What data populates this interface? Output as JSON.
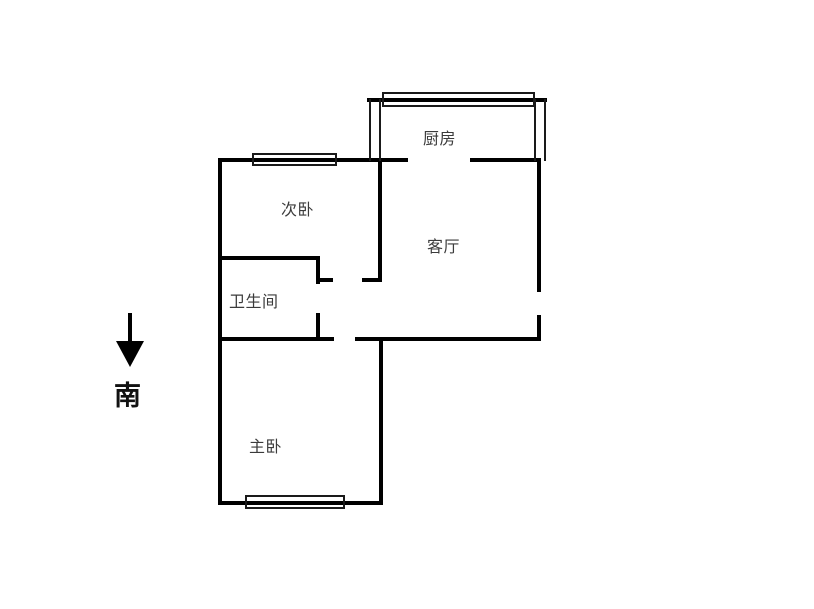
{
  "floorplan": {
    "rooms": [
      {
        "id": "kitchen",
        "label": "厨房"
      },
      {
        "id": "secondary-bedroom",
        "label": "次卧"
      },
      {
        "id": "living-room",
        "label": "客厅"
      },
      {
        "id": "bathroom",
        "label": "卫生间"
      },
      {
        "id": "master-bedroom",
        "label": "主卧"
      }
    ],
    "compass": {
      "label": "南",
      "direction": "south"
    },
    "colors": {
      "wall": "#000000",
      "window_border": "#1a1a1a",
      "label_text": "#3b3b3b",
      "background": "#ffffff"
    }
  }
}
